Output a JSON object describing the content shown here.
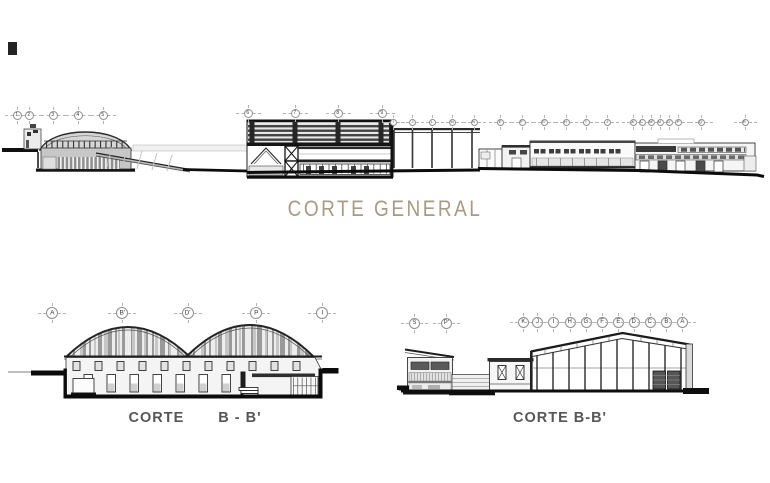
{
  "meta": {
    "width": 770,
    "height": 483
  },
  "colors": {
    "background": "#ffffff",
    "ink": "#1d1d1d",
    "title_tan": "#a89b85",
    "label_gray": "#565656",
    "fill_light": "#ededed",
    "fill_mid": "#c7c7c7",
    "stripe_gray": "#9a9a9a"
  },
  "titles": {
    "general": "CORTE GENERAL",
    "left_word": "CORTE",
    "left_section": "B - B'",
    "right": "CORTE B-B'"
  },
  "bubble_groups": [
    {
      "id": "general-numeric-left",
      "y": 115,
      "d": 9,
      "fs": 5,
      "items": [
        {
          "label": "1",
          "x": 17
        },
        {
          "label": "2",
          "x": 29
        },
        {
          "label": "3",
          "x": 53
        },
        {
          "label": "4",
          "x": 78
        },
        {
          "label": "5",
          "x": 103
        }
      ]
    },
    {
      "id": "general-numeric-mid",
      "y": 113,
      "d": 9,
      "fs": 5,
      "items": [
        {
          "label": "6",
          "x": 248
        },
        {
          "label": "7",
          "x": 295
        },
        {
          "label": "8",
          "x": 338
        },
        {
          "label": "9",
          "x": 382
        }
      ]
    },
    {
      "id": "general-letters",
      "y": 122,
      "d": 7,
      "fs": 4,
      "items": [
        {
          "label": "I",
          "x": 393
        },
        {
          "label": "J",
          "x": 412
        },
        {
          "label": "L",
          "x": 432
        },
        {
          "label": "M",
          "x": 452
        },
        {
          "label": "N",
          "x": 474
        },
        {
          "label": "E'",
          "x": 500
        },
        {
          "label": "F'",
          "x": 522
        },
        {
          "label": "G'",
          "x": 544
        },
        {
          "label": "H'",
          "x": 566
        },
        {
          "label": "I'",
          "x": 586
        },
        {
          "label": "J'",
          "x": 607
        },
        {
          "label": "K'",
          "x": 633
        },
        {
          "label": "L'",
          "x": 642
        },
        {
          "label": "M'",
          "x": 651
        },
        {
          "label": "N'",
          "x": 660
        },
        {
          "label": "O'",
          "x": 669
        },
        {
          "label": "P'",
          "x": 678
        },
        {
          "label": "Q'",
          "x": 701
        },
        {
          "label": "R'",
          "x": 745
        }
      ]
    },
    {
      "id": "corte-left",
      "y": 313,
      "d": 12,
      "fs": 6.5,
      "items": [
        {
          "label": "A",
          "x": 52
        },
        {
          "label": "B'",
          "x": 122
        },
        {
          "label": "D'",
          "x": 188
        },
        {
          "label": "P",
          "x": 256
        },
        {
          "label": "I",
          "x": 322
        }
      ]
    },
    {
      "id": "corte-right-pair",
      "y": 323,
      "d": 11,
      "fs": 6,
      "items": [
        {
          "label": "S",
          "x": 414
        },
        {
          "label": "P'",
          "x": 446
        }
      ]
    },
    {
      "id": "corte-right-row",
      "y": 322,
      "d": 11,
      "fs": 6,
      "items": [
        {
          "label": "K",
          "x": 523
        },
        {
          "label": "J",
          "x": 537
        },
        {
          "label": "I",
          "x": 553
        },
        {
          "label": "H",
          "x": 570
        },
        {
          "label": "G",
          "x": 586
        },
        {
          "label": "F",
          "x": 602
        },
        {
          "label": "E",
          "x": 618
        },
        {
          "label": "D",
          "x": 634
        },
        {
          "label": "C",
          "x": 650
        },
        {
          "label": "B",
          "x": 666
        },
        {
          "label": "A",
          "x": 682
        }
      ]
    }
  ]
}
